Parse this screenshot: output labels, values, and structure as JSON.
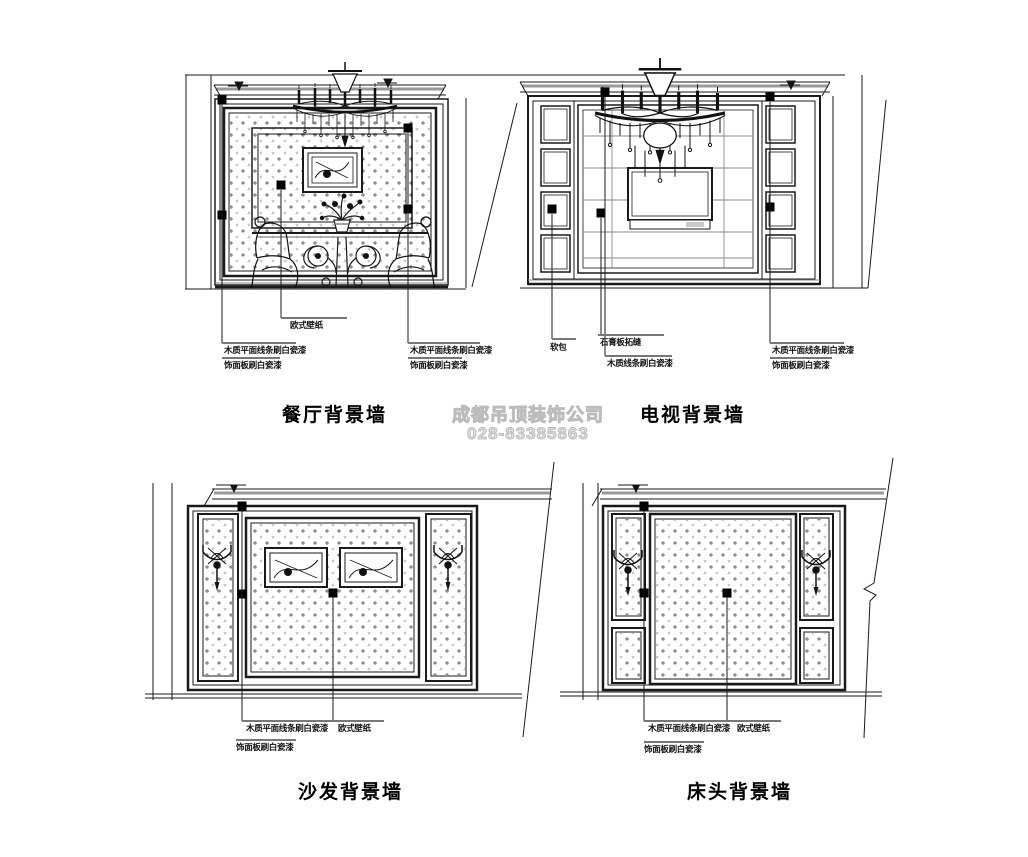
{
  "watermark": {
    "company": "成都吊顶装饰公司",
    "phone": "028-83385863"
  },
  "drawings": {
    "dining": {
      "title": "餐厅背景墙",
      "annotations": {
        "wallpaper": "欧式壁纸",
        "left_line1": "木质平面线条刷白瓷漆",
        "left_line2": "饰面板刷白瓷漆",
        "right_line1": "木质平面线条刷白瓷漆",
        "right_line2": "饰面板刷白瓷漆"
      }
    },
    "tv": {
      "title": "电视背景墙",
      "annotations": {
        "soft_pad": "软包",
        "gypsum": "石膏板拓缝",
        "wood_line": "木质线条刷白瓷漆",
        "right_line1": "木质平面线条刷白瓷漆",
        "right_line2": "饰面板刷白瓷漆"
      }
    },
    "sofa": {
      "title": "沙发背景墙",
      "annotations": {
        "left_line1": "木质平面线条刷白瓷漆",
        "left_line2": "饰面板刷白瓷漆",
        "wallpaper": "欧式壁纸"
      }
    },
    "bed": {
      "title": "床头背景墙",
      "annotations": {
        "left_line1": "木质平面线条刷白瓷漆",
        "left_line2": "饰面板刷白瓷漆",
        "wallpaper": "欧式壁纸"
      }
    }
  },
  "colors": {
    "line": "#1a1a1a",
    "grid": "#8a8a8a",
    "watermark": "#dcdcdc"
  }
}
